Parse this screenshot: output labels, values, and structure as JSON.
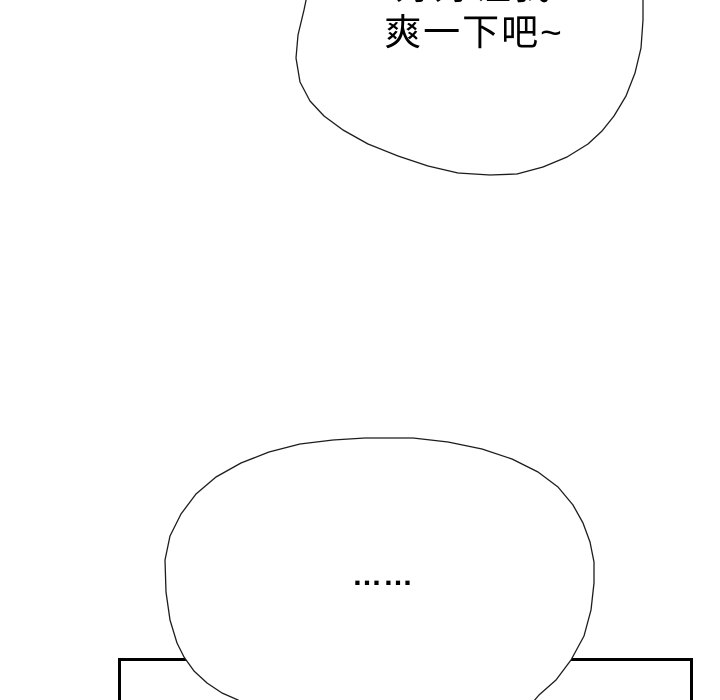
{
  "scene": {
    "background": "#ffffff"
  },
  "top_bubble": {
    "line1": "好好让我",
    "line2": "爽一下吧~"
  },
  "bottom_bubble": {
    "ellipsis": "……"
  },
  "colors": {
    "bubble_outline": "#1c1c1c",
    "panel_border": "#000000",
    "text": "#000000",
    "bubble_fill": "#ffffff"
  }
}
